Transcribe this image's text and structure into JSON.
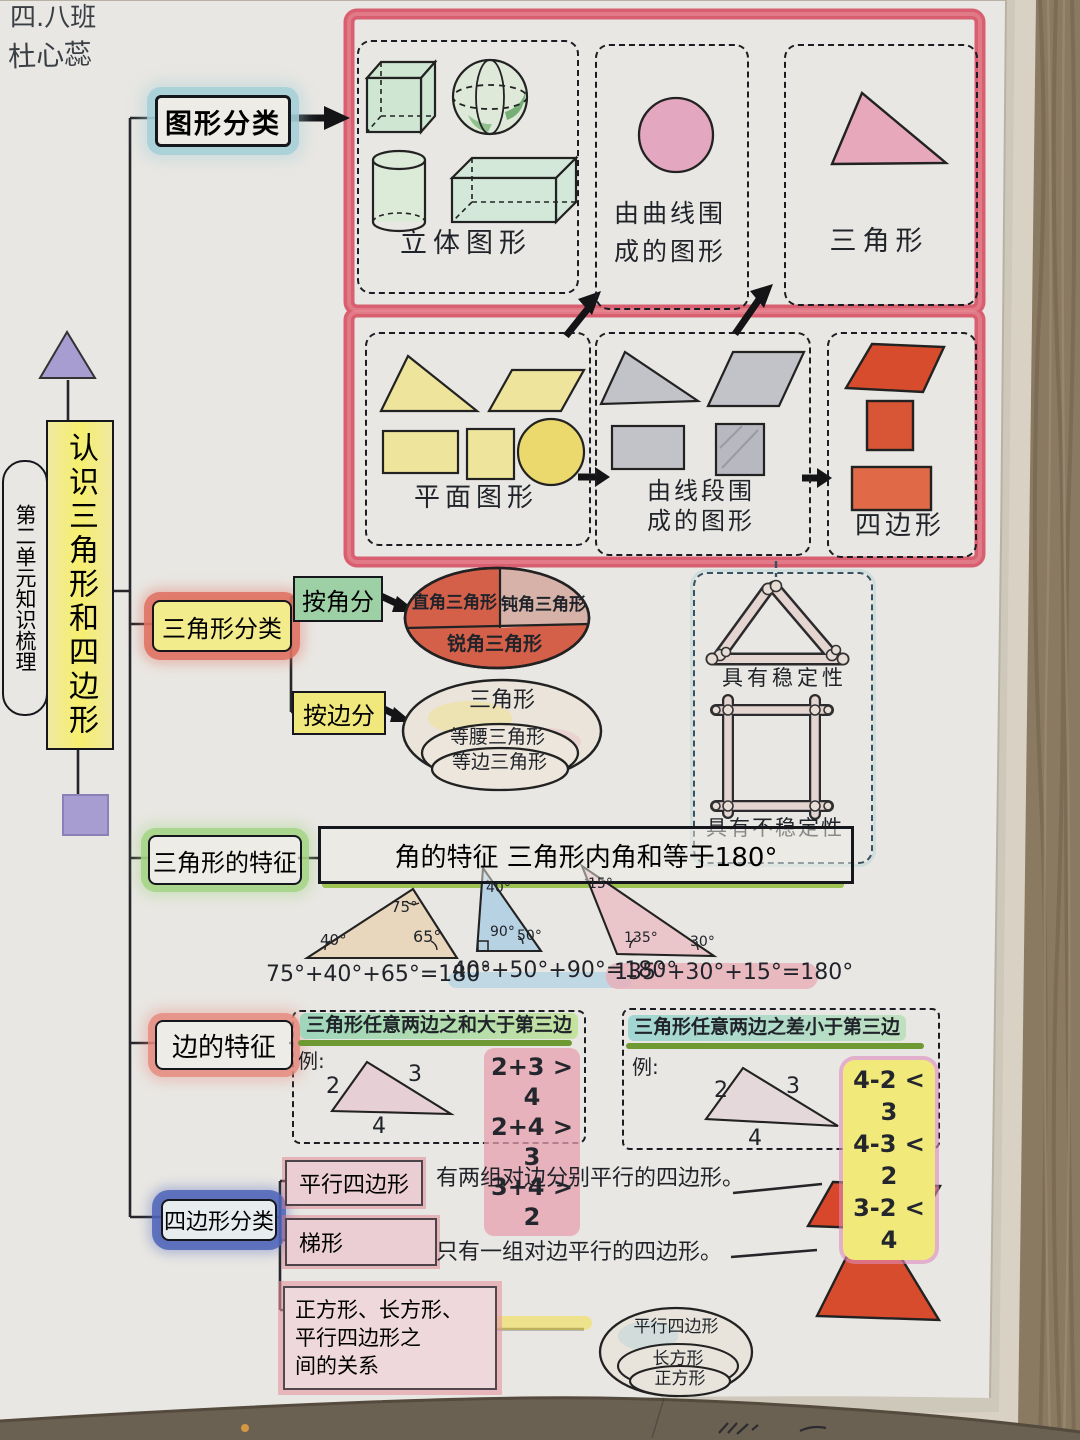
{
  "page": {
    "class_name": "四.八班",
    "student_name": "杜心蕊"
  },
  "root": {
    "title": "认识三角形和四边形",
    "unit": "第二单元知识梳理"
  },
  "shapes": {
    "node": "图形分类",
    "solid_label": "立体图形",
    "curve_label_1": "由曲线围",
    "curve_label_2": "成的图形",
    "triangle_label": "三角形",
    "plane_label": "平面图形",
    "segment_label_1": "由线段围",
    "segment_label_2": "成的图形",
    "quad_label": "四边形"
  },
  "tri_class": {
    "node": "三角形分类",
    "by_angle": "按角分",
    "angle_right": "直角三角形",
    "angle_obtuse": "钝角三角形",
    "angle_acute": "锐角三角形",
    "by_side": "按边分",
    "side_outer": "三角形",
    "side_middle": "等腰三角形",
    "side_inner": "等边三角形",
    "stable": "具有稳定性",
    "unstable": "具有不稳定性"
  },
  "tri_feat": {
    "node": "三角形的特征",
    "angle_rule": "角的特征  三角形内角和等于180°",
    "tri1": {
      "top": "75°",
      "left": "40°",
      "right": "65°",
      "eq": "75°+40°+65°=180°"
    },
    "tri2": {
      "top": "40°",
      "left": "90°",
      "right": "50°",
      "eq": "40°+50°+90°=180°"
    },
    "tri3": {
      "top": "15°",
      "left": "135°",
      "right": "30°",
      "eq": "135°+30°+15°=180°"
    }
  },
  "side_feat": {
    "node": "边的特征",
    "rule1": {
      "title": "三角形任意两边之和大于第三边",
      "example": "例:",
      "s1": "2",
      "s2": "3",
      "s3": "4",
      "ineq": [
        "2+3 > 4",
        "2+4 > 3",
        "3+4 > 2"
      ]
    },
    "rule2": {
      "title": "三角形任意两边之差小于第三边",
      "example": "例:",
      "s1": "2",
      "s2": "3",
      "s3": "4",
      "ineq": [
        "4-2 < 3",
        "4-3 < 2",
        "3-2 < 4"
      ]
    }
  },
  "quad_class": {
    "node": "四边形分类",
    "parallelogram": "平行四边形",
    "parallelogram_desc": "有两组对边分别平行的四边形。",
    "trapezoid": "梯形",
    "trapezoid_desc": "只有一组对边平行的四边形。",
    "relations_1": "正方形、长方形、",
    "relations_2": "平行四边形之",
    "relations_3": "间的关系",
    "venn": [
      "平行四边形",
      "长方形",
      "正方形"
    ]
  },
  "colors": {
    "crayon_red_border": "#d85f6f",
    "highlight_blue": "#a9d3da",
    "highlight_green": "#a8d88e",
    "highlight_yellow": "#f1e87e",
    "highlight_red": "#e4796d",
    "crayon_blue": "#4f63b8",
    "shape_red": "#d84c2e",
    "shape_pink": "#e4a9bf",
    "shape_yellow": "#efe49c",
    "shape_green": "#cfe7d2",
    "shape_gray": "#c2c3c9"
  }
}
